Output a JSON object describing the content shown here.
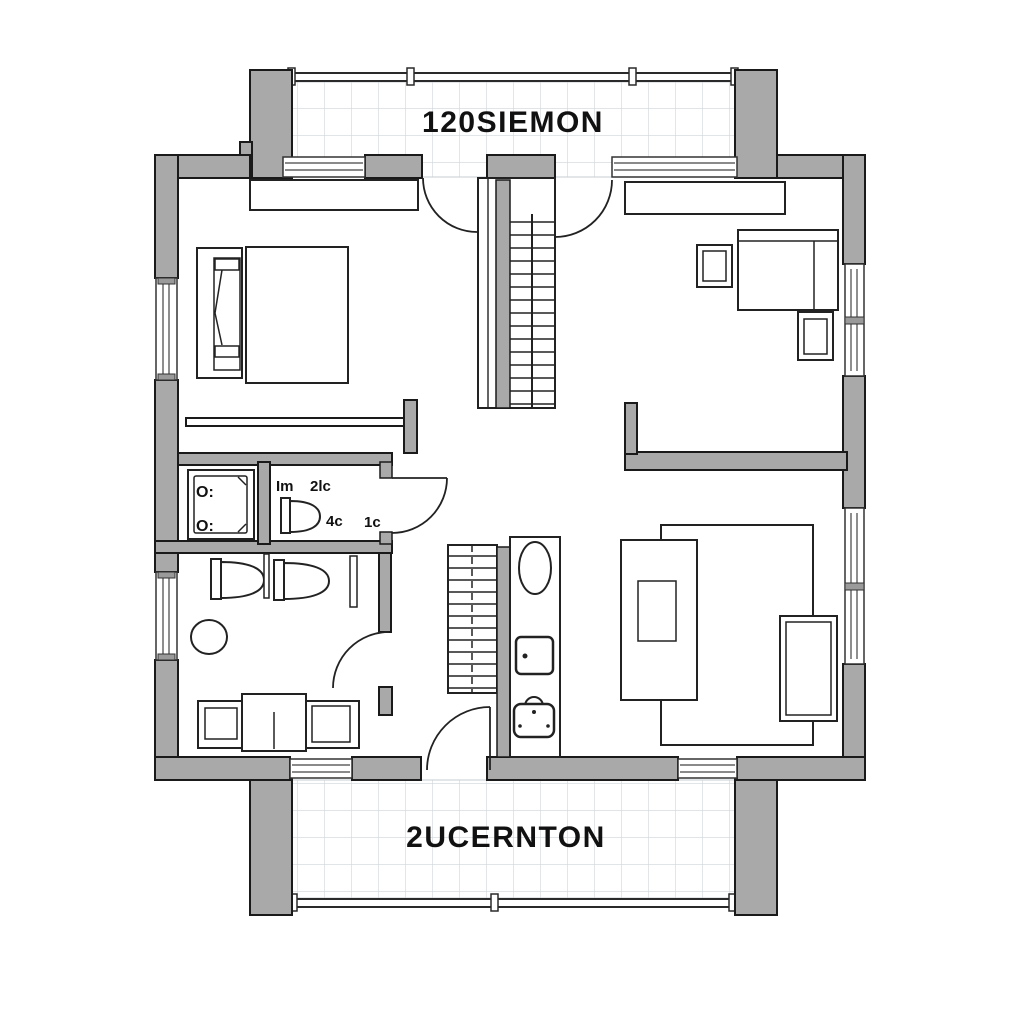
{
  "colors": {
    "wall_fill": "#a9a9a9",
    "outline": "#1a1a1a",
    "tile_grid": "#d0d5da",
    "paper": "#ffffff"
  },
  "plan": {
    "balcony": {
      "label": "120SIEMON"
    },
    "terrace": {
      "label": "2UCERNTON"
    },
    "wc_notes": [
      "Im",
      "2lc",
      "4c",
      "1c"
    ],
    "shower_marks": [
      "O:",
      "O:"
    ]
  }
}
